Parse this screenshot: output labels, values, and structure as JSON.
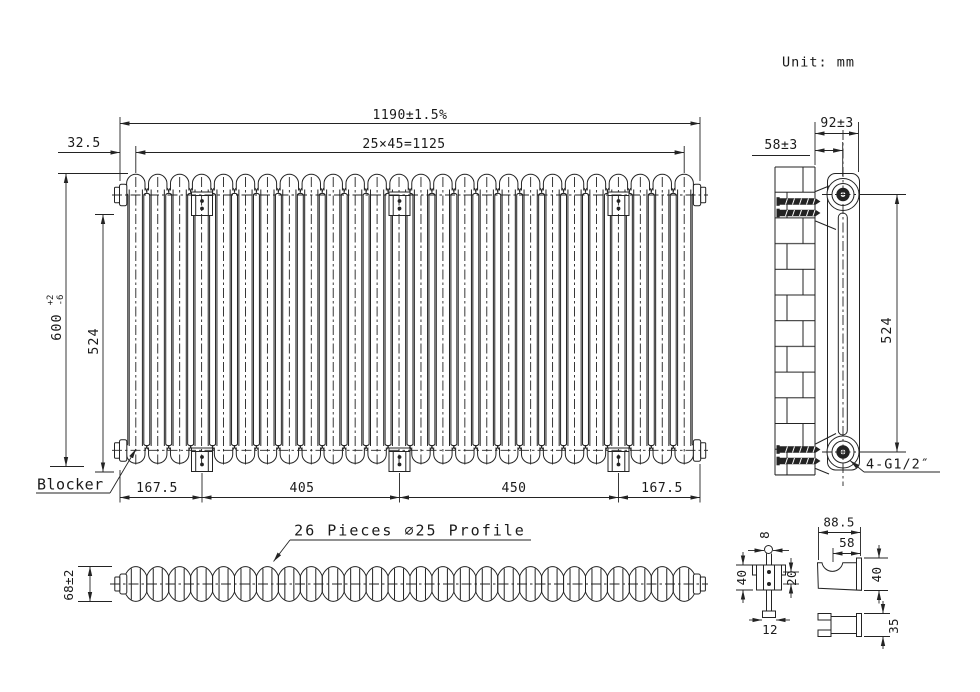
{
  "unit_note": "Unit: mm",
  "front_view": {
    "sections": 26,
    "dim_overall_width": "1190±1.5%",
    "dim_section_pitch": "25×45=1125",
    "dim_end_offset": "32.5",
    "dim_overall_height": "600",
    "dim_overall_height_tol_upper": "+2",
    "dim_overall_height_tol_lower": "-6",
    "dim_tapping_height": "524",
    "blocker_label": "Blocker",
    "dim_bottom_segments": [
      "167.5",
      "405",
      "450",
      "167.5"
    ]
  },
  "side_view": {
    "dim_depth": "92±3",
    "dim_wall_to_center": "58±3",
    "dim_connection_height": "524",
    "connection_label": "4-G1/2″"
  },
  "profile_view": {
    "pieces": 26,
    "label": "26 Pieces ∅25 Profile",
    "dim_height": "68±2"
  },
  "details": {
    "bracket_front": {
      "dim_pin": "8",
      "dim_height": "40",
      "dim_hole_spacing": "20",
      "dim_width": "12"
    },
    "bracket_side": {
      "dim_length": "88.5",
      "dim_hook": "58",
      "dim_height": "40"
    },
    "clip": {
      "dim_height": "35"
    }
  },
  "colors": {
    "line": "#232323",
    "background": "#ffffff"
  }
}
